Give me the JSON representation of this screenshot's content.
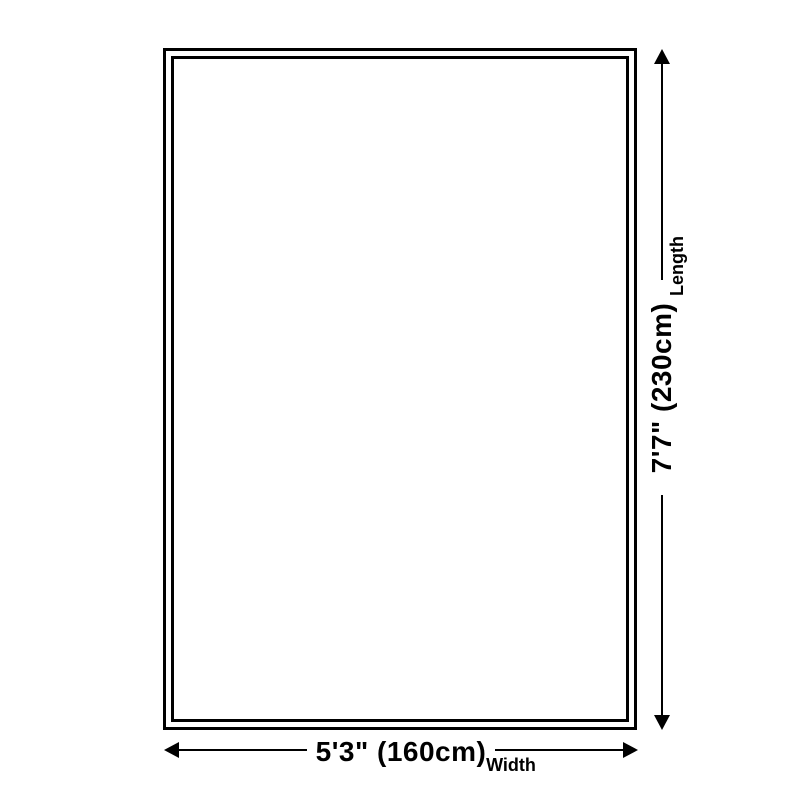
{
  "diagram": {
    "type": "size-dimension-diagram",
    "colors": {
      "background": "#ffffff",
      "line": "#000000",
      "text": "#000000"
    },
    "rug": {
      "shape": "rectangle",
      "border_style": "double"
    },
    "length": {
      "name": "Length",
      "value": "7'7\" (230cm)"
    },
    "width": {
      "name": "Width",
      "value": "5'3\" (160cm)"
    }
  }
}
